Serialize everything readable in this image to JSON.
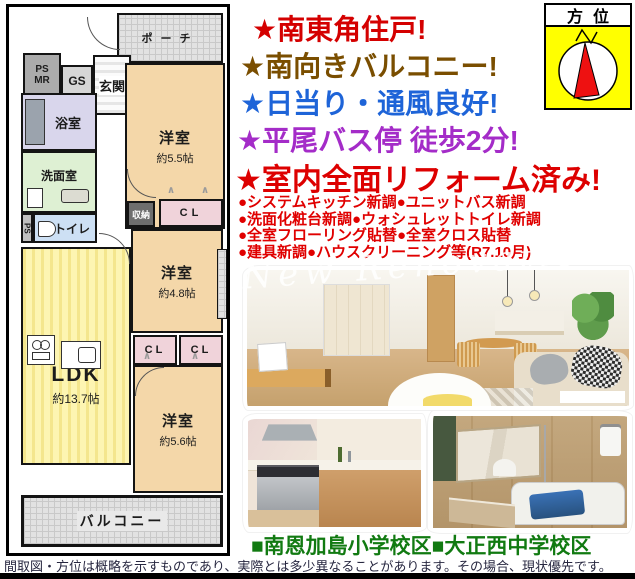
{
  "compass": {
    "title": "方位",
    "needle_color": "#ee1111",
    "bg_color": "#ffff00"
  },
  "headlines": [
    {
      "text": "★南東角住戸!",
      "color": "#d40000"
    },
    {
      "text": "★南向きバルコニー!",
      "color": "#7a4e00"
    },
    {
      "text": "★日当り・通風良好!",
      "color": "#1e64d8"
    },
    {
      "text": "★平尾バス停 徒歩2分!",
      "color": "#a42cc8"
    },
    {
      "text": "★室内全面リフォーム済み!",
      "color": "#dd0000"
    }
  ],
  "bullets": {
    "line1": "●システムキッチン新調●ユニットバス新調",
    "line2": "●洗面化粧台新調●ウォシュレットトイレ新調",
    "line3": "●全室フローリング貼替●全室クロス貼替",
    "line4": "●建具新調●ハウスクリーニング等(R7.10月)"
  },
  "watermark": "New Renovation",
  "school_line": "■南恩加島小学校区■大正西中学校区",
  "disclaimer": "間取図・方位は概略を示すものであり、実際とは多少異なることがあります。その場合、現状優先です。",
  "floorplan": {
    "porch": "ポーチ",
    "ps": "PS",
    "mr": "MR",
    "gs": "GS",
    "entrance": "玄関",
    "bath": "浴室",
    "washroom": "洗面室",
    "toilet": "トイレ",
    "ps2": "PS",
    "storage": "収納",
    "cl1": "CL",
    "cl2": "CL",
    "cl3": "CL",
    "room1": {
      "name": "洋室",
      "size": "約5.5帖"
    },
    "room2": {
      "name": "洋室",
      "size": "約4.8帖"
    },
    "room3": {
      "name": "洋室",
      "size": "約5.6帖"
    },
    "ldk": {
      "name": "LDK",
      "size": "約13.7帖"
    },
    "balcony": "バルコニー"
  }
}
